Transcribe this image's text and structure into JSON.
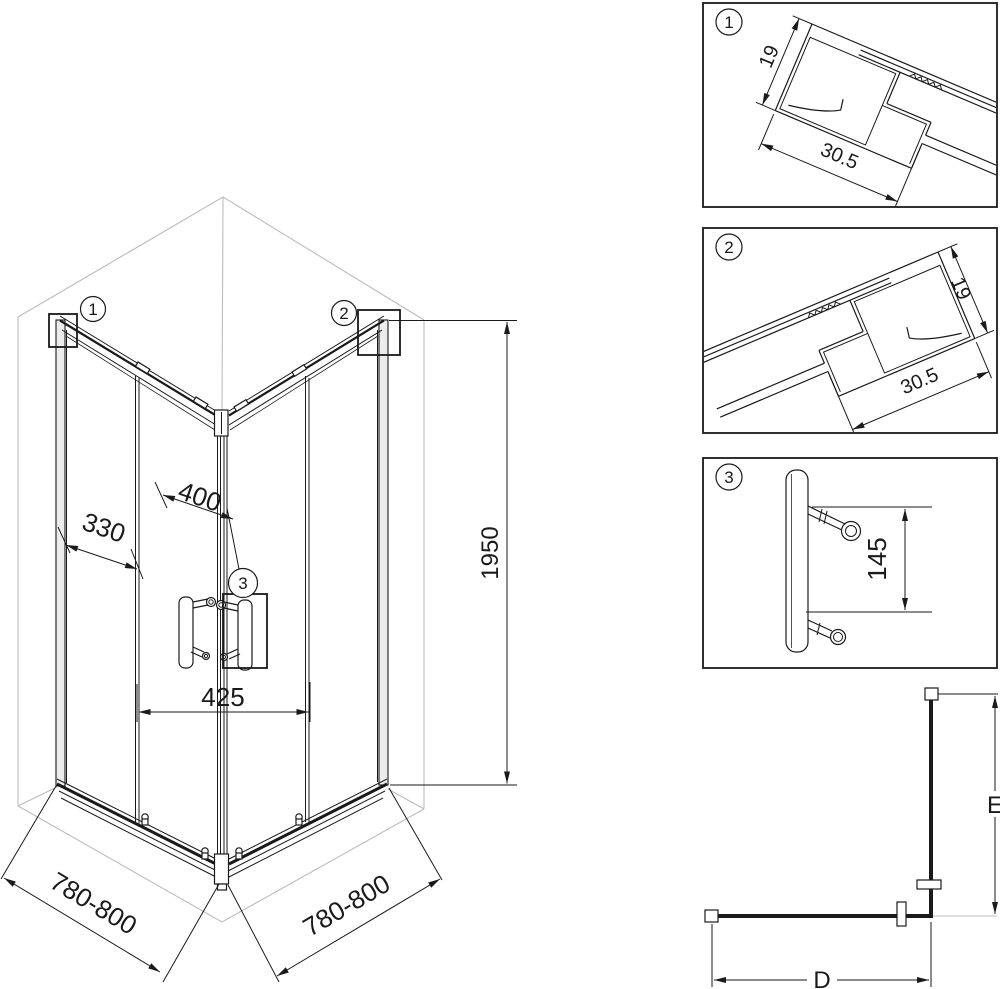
{
  "drawing": {
    "callouts": {
      "c1": "1",
      "c2": "2",
      "c3": "3"
    },
    "main": {
      "dim_fixed_panel": "330",
      "dim_door": "400",
      "dim_door_span": "425",
      "dim_height": "1950",
      "dim_width_left": "780-800",
      "dim_width_right": "780-800"
    },
    "detail1": {
      "label": "1",
      "dim_height": "19",
      "dim_width": "30.5"
    },
    "detail2": {
      "label": "2",
      "dim_height": "19",
      "dim_width": "30.5"
    },
    "detail3": {
      "label": "3",
      "dim_post_spacing": "145"
    },
    "plan": {
      "dim_width": "D",
      "dim_depth": "E"
    }
  },
  "colors": {
    "line": "#1a1a1a",
    "room_gray": "#bcbcbc",
    "profile_fill": "#ececec",
    "background": "#ffffff"
  }
}
